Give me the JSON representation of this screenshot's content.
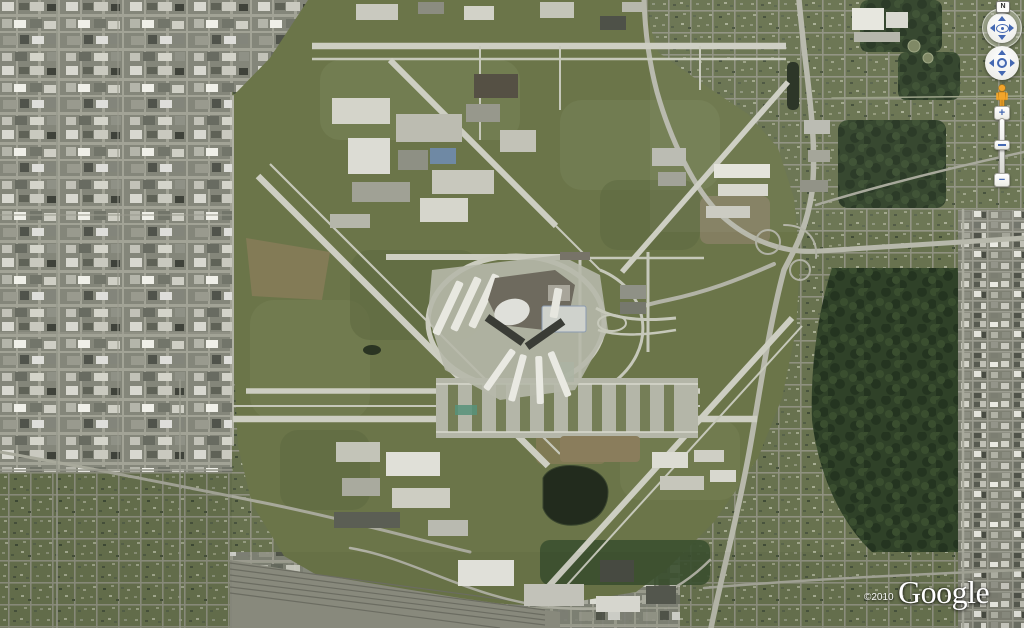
{
  "attribution": {
    "copyright": "©2010",
    "logo_text": "Google"
  },
  "navigation": {
    "north_label": "N",
    "icons": [
      "north-button",
      "look-joystick",
      "look-up-arrow",
      "look-down-arrow",
      "look-left-arrow",
      "look-right-arrow",
      "eye-icon",
      "pan-joystick",
      "pan-up-arrow",
      "pan-down-arrow",
      "pan-left-arrow",
      "pan-right-arrow",
      "pegman-icon",
      "zoom-in-button",
      "zoom-slider",
      "zoom-slider-handle",
      "zoom-out-button"
    ]
  },
  "zoom_control": {
    "zoom_in_label": "+",
    "zoom_out_label": "−"
  },
  "map": {
    "type": "satellite aerial imagery",
    "palette": {
      "airfield_green": "#6b7549",
      "forest_green": "#2f4128",
      "suburb_green": "#68724f",
      "urban_gray": "#84867a",
      "runway_gray": "#cdcec2",
      "highway_gray": "#b7b8ab",
      "water_dark": "#222b1d",
      "control_blue": "#4468b2",
      "pegman_orange": "#f2a52b"
    },
    "regions": [
      {
        "name": "industrial-grid-west"
      },
      {
        "name": "residential-grid-southwest"
      },
      {
        "name": "airport-airfield-center"
      },
      {
        "name": "terminal-complex"
      },
      {
        "name": "runways-and-taxiways"
      },
      {
        "name": "cargo-aprons"
      },
      {
        "name": "retention-pond"
      },
      {
        "name": "rail-yard-south"
      },
      {
        "name": "highway-interchange-east"
      },
      {
        "name": "forest-preserve-east"
      },
      {
        "name": "residential-grid-northeast"
      },
      {
        "name": "commercial-strip-far-east"
      }
    ]
  }
}
